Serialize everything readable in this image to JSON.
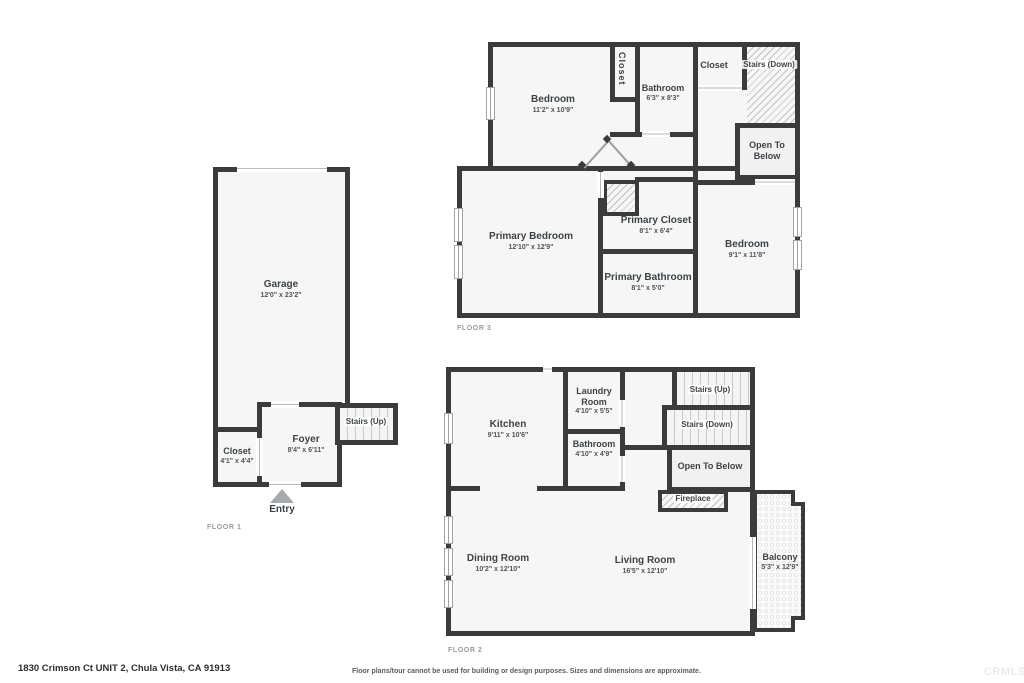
{
  "page": {
    "address": "1830 Crimson Ct UNIT 2, Chula Vista, CA 91913",
    "disclaimer": "Floor plans/tour cannot be used for building or design purposes. Sizes and dimensions are approximate.",
    "watermark": "CRMLS"
  },
  "colors": {
    "wall": "#3b3b3b",
    "room_fill": "#f6f6f6",
    "label_text": "#3e4347",
    "floor_tag_text": "#9a9a9a"
  },
  "floor1": {
    "tag": "FLOOR 1",
    "garage": {
      "name": "Garage",
      "dims": "12'0\" x 23'2\""
    },
    "closet": {
      "name": "Closet",
      "dims": "4'1\" x 4'4\""
    },
    "foyer": {
      "name": "Foyer",
      "dims": "8'4\" x 6'11\""
    },
    "stairs_up": {
      "name": "Stairs (Up)"
    },
    "entry": {
      "name": "Entry"
    }
  },
  "floor2": {
    "tag": "FLOOR 2",
    "kitchen": {
      "name": "Kitchen",
      "dims": "9'11\" x 10'6\""
    },
    "laundry": {
      "name": "Laundry Room",
      "dims": "4'10\" x 5'5\""
    },
    "bathroom": {
      "name": "Bathroom",
      "dims": "4'10\" x 4'9\""
    },
    "stairs_up": {
      "name": "Stairs (Up)"
    },
    "stairs_down": {
      "name": "Stairs (Down)"
    },
    "open_below": {
      "name": "Open To Below"
    },
    "fireplace": {
      "name": "Fireplace"
    },
    "dining": {
      "name": "Dining Room",
      "dims": "10'2\" x 12'10\""
    },
    "living": {
      "name": "Living Room",
      "dims": "16'5\" x 12'10\""
    },
    "balcony": {
      "name": "Balcony",
      "dims": "5'3\" x 12'9\""
    }
  },
  "floor3": {
    "tag": "FLOOR 3",
    "bedroom_top": {
      "name": "Bedroom",
      "dims": "11'2\" x 10'9\""
    },
    "closet_mid": {
      "name": "Closet"
    },
    "bathroom": {
      "name": "Bathroom",
      "dims": "6'3\" x 8'3\""
    },
    "closet_top": {
      "name": "Closet"
    },
    "stairs_down": {
      "name": "Stairs (Down)"
    },
    "open_below": {
      "name": "Open To Below"
    },
    "primary_bedroom": {
      "name": "Primary Bedroom",
      "dims": "12'10\" x 12'9\""
    },
    "primary_closet": {
      "name": "Primary Closet",
      "dims": "8'1\" x 6'4\""
    },
    "primary_bathroom": {
      "name": "Primary Bathroom",
      "dims": "8'1\" x 5'0\""
    },
    "bedroom_right": {
      "name": "Bedroom",
      "dims": "9'1\" x 11'8\""
    }
  }
}
